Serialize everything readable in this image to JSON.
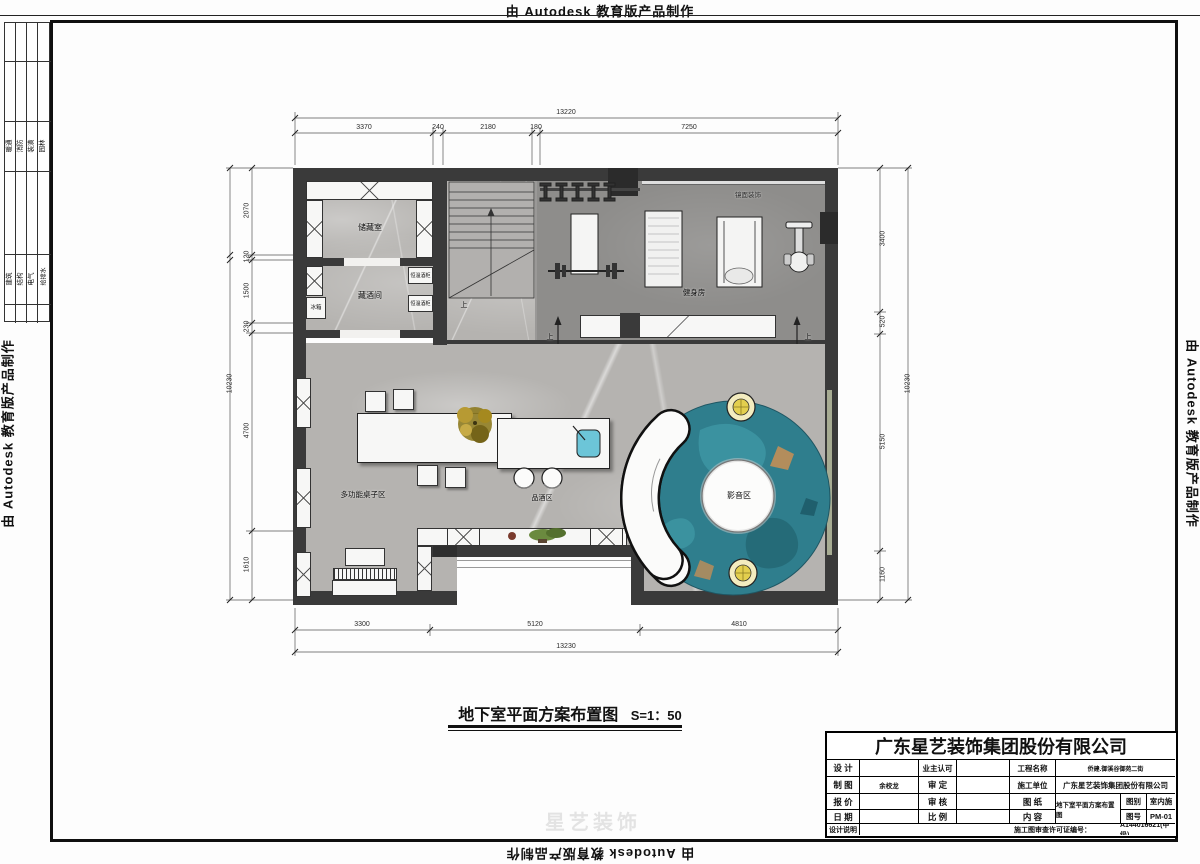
{
  "frame": {
    "autodesk_note": "由 Autodesk 教育版产品制作"
  },
  "disciplines": {
    "group1": [
      "暖通",
      "消防",
      "装潢",
      "园林"
    ],
    "group2": [
      "建筑",
      "结构",
      "电气",
      "给排水"
    ]
  },
  "plan": {
    "labels": {
      "storage_room": "储藏室",
      "wine_room": "藏酒间",
      "fridge": "冰箱",
      "wine_cabinet_a": "恒温酒柜",
      "wine_cabinet_b": "恒温酒柜",
      "mirror_decor": "镜面装饰",
      "gym": "健身房",
      "multi_table_area": "多功能桌子区",
      "tasting_area": "品酒区",
      "media_area": "影音区",
      "up_stairs": "上",
      "up_left": "上",
      "up_right": "上"
    },
    "caption": {
      "title": "地下室平面方案布置图",
      "scale": "S=1：50"
    }
  },
  "dimensions": {
    "top": {
      "total": "13220",
      "segments": [
        "3370",
        "240",
        "2180",
        "180",
        "7250"
      ]
    },
    "bottom": {
      "total": "13230",
      "segments": [
        "3300",
        "5120",
        "4810"
      ]
    },
    "left": {
      "total": "10230",
      "segments": [
        "2070",
        "120",
        "1500",
        "230",
        "4700",
        "1610"
      ]
    },
    "right": {
      "total": "10230",
      "segments": [
        "3400",
        "520",
        "5150",
        "1160"
      ]
    }
  },
  "title_block": {
    "company": "广东星艺装饰集团股份有限公司",
    "design_label": "设 计",
    "design_value": "",
    "draft_label": "制 图",
    "draft_value": "余校龙",
    "quote_label": "报 价",
    "quote_value": "",
    "date_label": "日 期",
    "date_value": "",
    "owner_label": "业主认可",
    "owner_value": "",
    "approve_label": "审 定",
    "approve_value": "",
    "review_label": "审 核",
    "review_value": "",
    "scale_label": "比 例",
    "scale_value": "",
    "project_label": "工程名称",
    "project_value": "侨建.御溪谷御苑二街",
    "builder_label": "施工单位",
    "builder_value": "广东星艺装饰集团股份有限公司",
    "drawing_label": "图 纸",
    "content_label": "内 容",
    "drawing_value": "地下室平面方案布置图",
    "category_label": "图别",
    "category_value": "室内施",
    "number_label": "图号",
    "number_value": "PM-01",
    "notes_label": "设计说明",
    "license_label": "施工图审查许可证编号：",
    "license_value": "A144016621(甲级)"
  },
  "watermark": "星艺装饰"
}
